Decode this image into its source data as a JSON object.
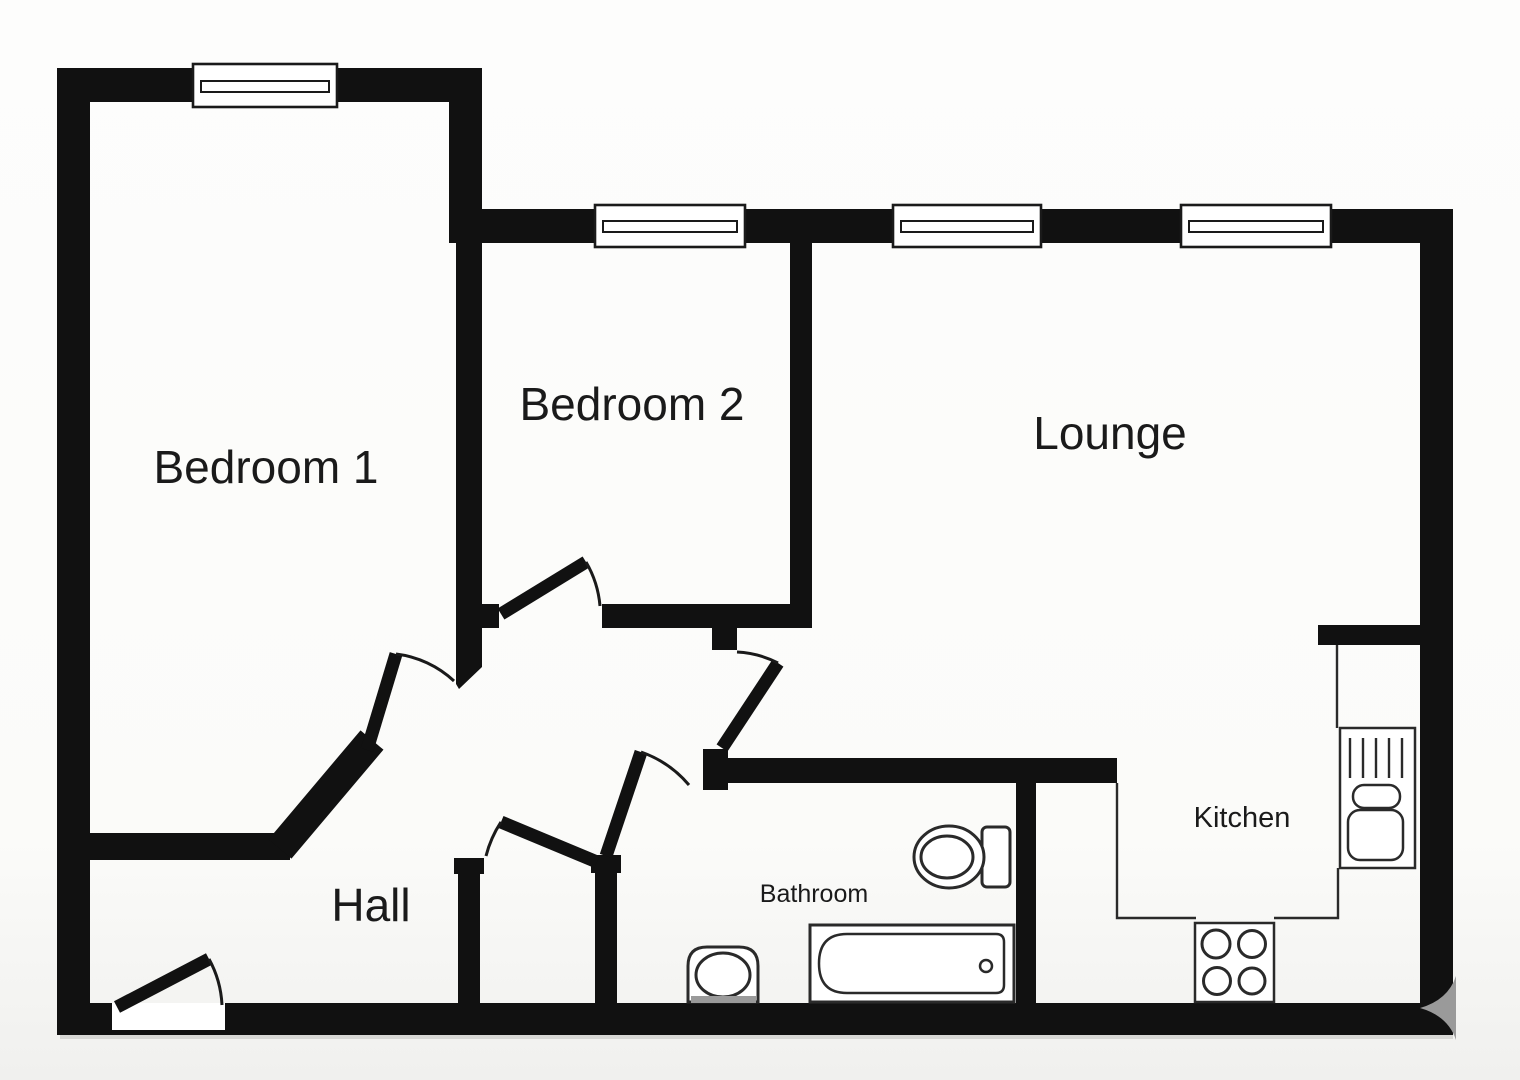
{
  "colors": {
    "wall": "#111111",
    "line": "#1a1a1a",
    "fixture": "#2a2a2a",
    "shadow": "#c9c9c6",
    "watermark": "#9a9a9a",
    "background": "#fbfbfa"
  },
  "rooms": {
    "bedroom1": {
      "label": "Bedroom 1"
    },
    "bedroom2": {
      "label": "Bedroom 2"
    },
    "lounge": {
      "label": "Lounge"
    },
    "hall": {
      "label": "Hall"
    },
    "bathroom": {
      "label": "Bathroom"
    },
    "kitchen": {
      "label": "Kitchen"
    }
  },
  "windows": {
    "count": 4
  },
  "doors": {
    "count": 6,
    "names": [
      "entry-door",
      "bedroom1-door",
      "bedroom2-door",
      "corridor-door",
      "bathroom-door",
      "closet-door"
    ]
  },
  "fixtures": [
    "toilet-icon",
    "bathtub-icon",
    "washbasin-icon",
    "kitchen-sink-icon",
    "hob-icon"
  ]
}
